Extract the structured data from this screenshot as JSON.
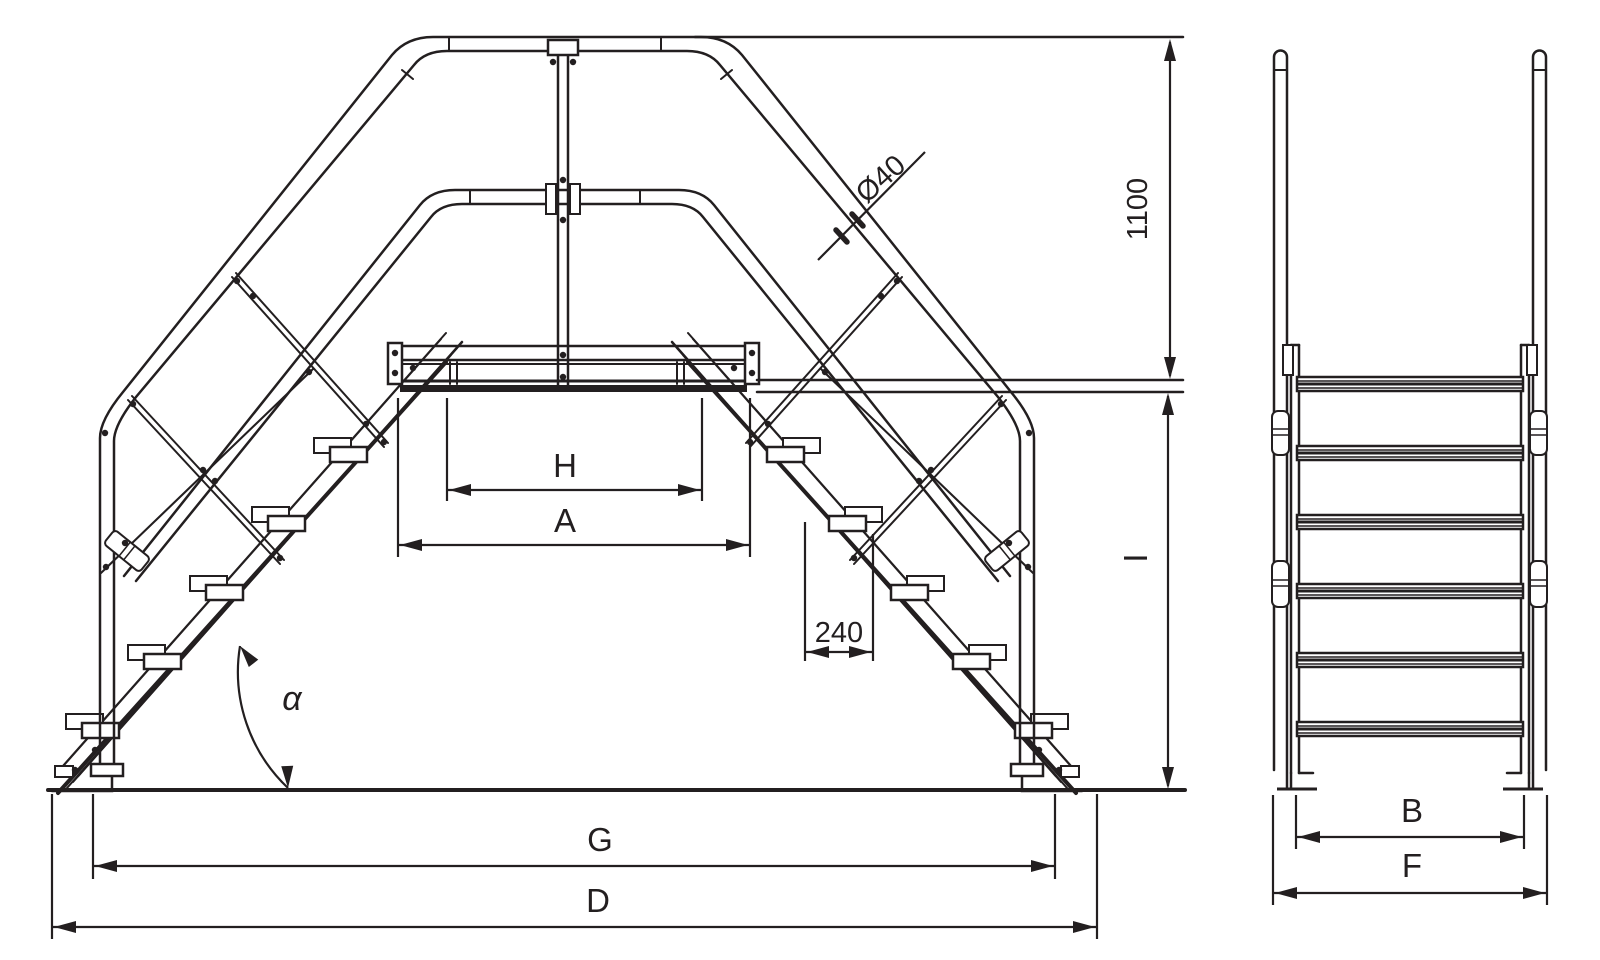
{
  "drawing": {
    "colors": {
      "line": "#231f20",
      "background": "#ffffff"
    },
    "dimensions": {
      "tube_diameter": "Ø40",
      "handrail_height": "1100",
      "platform_height": "I",
      "clear_width": "H",
      "platform_length": "A",
      "tread_pitch": "240",
      "incline_angle": "α",
      "inner_span": "G",
      "overall_span": "D",
      "step_width": "B",
      "overall_width": "F"
    }
  }
}
